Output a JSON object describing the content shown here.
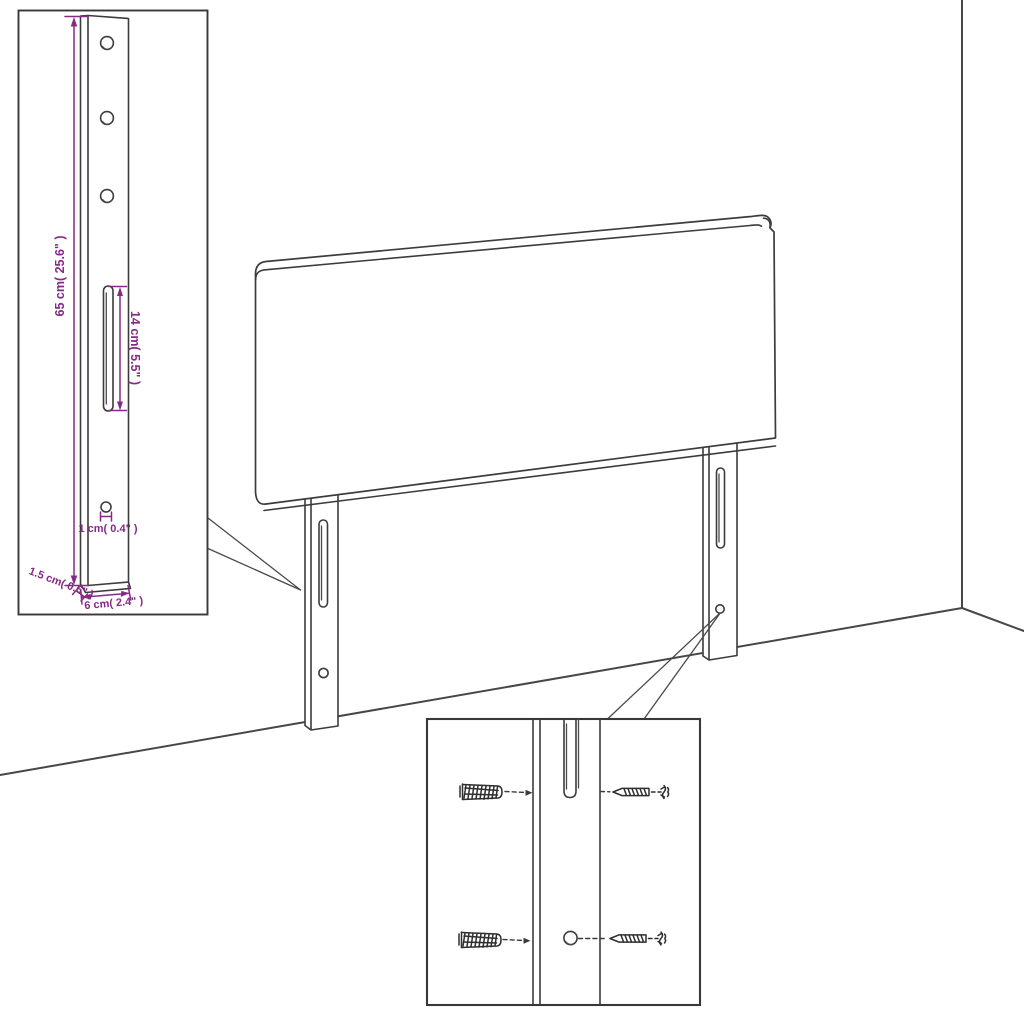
{
  "diagram": {
    "title": "headboard-dimension-diagram",
    "detail_leg": {
      "height_label": "65 cm( 25.6\" )",
      "slot_label": "14 cm( 5.5\" )",
      "hole_label": "1 cm( 0.4\" )",
      "edge_label": "1.5 cm( 0.6\" )",
      "width_label": "6 cm( 2.4\" )"
    },
    "colors": {
      "outline": "#3c3c3c",
      "dimension": "#862a86",
      "background": "#ffffff"
    }
  }
}
